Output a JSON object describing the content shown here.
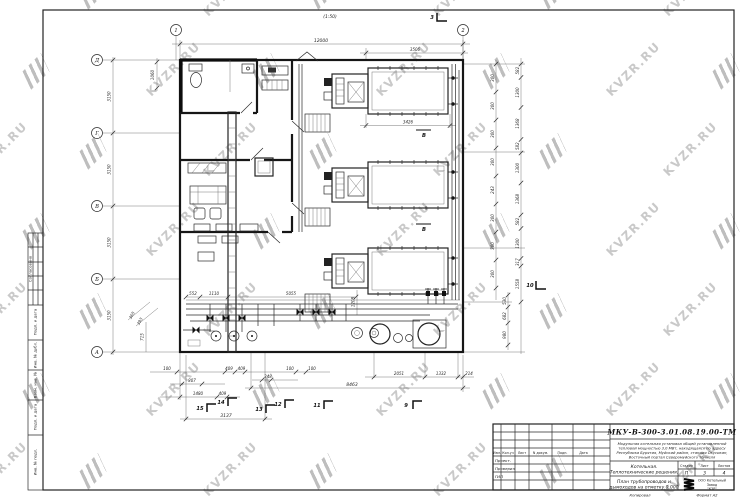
{
  "watermark": {
    "text": "KVZR.RU"
  },
  "frame": {
    "side_labels": [
      "Согласовано",
      "Подп. и дата",
      "Инв. № дубл.",
      "Взам. инв. №",
      "Подп. и дата",
      "Инв. № подл."
    ],
    "footer": {
      "left": "Копировал",
      "right": "Формат А2"
    }
  },
  "plan": {
    "scale": "(1:50)",
    "grid_cols": [
      "1",
      "2"
    ],
    "grid_rows": [
      "Д",
      "Г",
      "В",
      "Б",
      "А"
    ],
    "dims": {
      "top_overall": "12000",
      "top_sub": "3506",
      "boiler_width": "3426",
      "left_top": "1060",
      "left_bay": "3150",
      "right_outer": [
        "582",
        "1300",
        "1368",
        "582",
        "1300",
        "1368",
        "582",
        "1300",
        "317",
        "1558"
      ],
      "right_inner": [
        "300",
        "300",
        "300",
        "300",
        "243",
        "300",
        "300",
        "300"
      ],
      "right_bottom": [
        "530",
        "682",
        "980"
      ],
      "inner": {
        "a": "552",
        "b": "1110",
        "c": "5055",
        "d": "1208",
        "e": "715",
        "f": "365",
        "g": "393"
      },
      "bottom": {
        "d100a": "100",
        "d100b": "100",
        "d100c": "100",
        "d409a": "409",
        "d409b": "409",
        "d409c": "409",
        "d807": "807",
        "d1480": "1480",
        "d348": "348",
        "d3137": "3137",
        "d8463": "8463",
        "d2051": "2051",
        "d1332": "1332",
        "d214": "214"
      }
    },
    "sections": {
      "top": "3",
      "b15": "15",
      "b14": "14",
      "b13": "13",
      "b12": "12",
      "b11": "11",
      "b9": "9",
      "right": "10",
      "letter": "В"
    }
  },
  "title_block": {
    "doc_number": "МКУ-В-300-3.01.08.19.00-ТМ",
    "description": [
      "Модульная котельная установка общей установленной",
      "тепловой мощностью 3,0 МВт, находящаяся по адресу",
      "Республика Бурятия, Муйский район, станция Окусикан,",
      "Восточный портал Северомуйского тоннеля"
    ],
    "object": [
      "Котельная.",
      "Теплотехнические решения."
    ],
    "sheet_title": [
      "План трубопроводов и",
      "дымоходов на отметку 0,000"
    ],
    "labels": {
      "stage": "Стадия",
      "sheet": "Лист",
      "sheets": "Листов"
    },
    "values": {
      "stage": "П",
      "sheet": "3",
      "sheets": "4"
    },
    "company": [
      "ООО Котельный",
      "Завод",
      "\"КЗР\""
    ],
    "columns": [
      "Изм.",
      "Кол.уч",
      "Лист",
      "N докум.",
      "Подп.",
      "Дата"
    ],
    "rows": [
      "Проект.",
      "Проверил",
      "ГИП"
    ]
  }
}
